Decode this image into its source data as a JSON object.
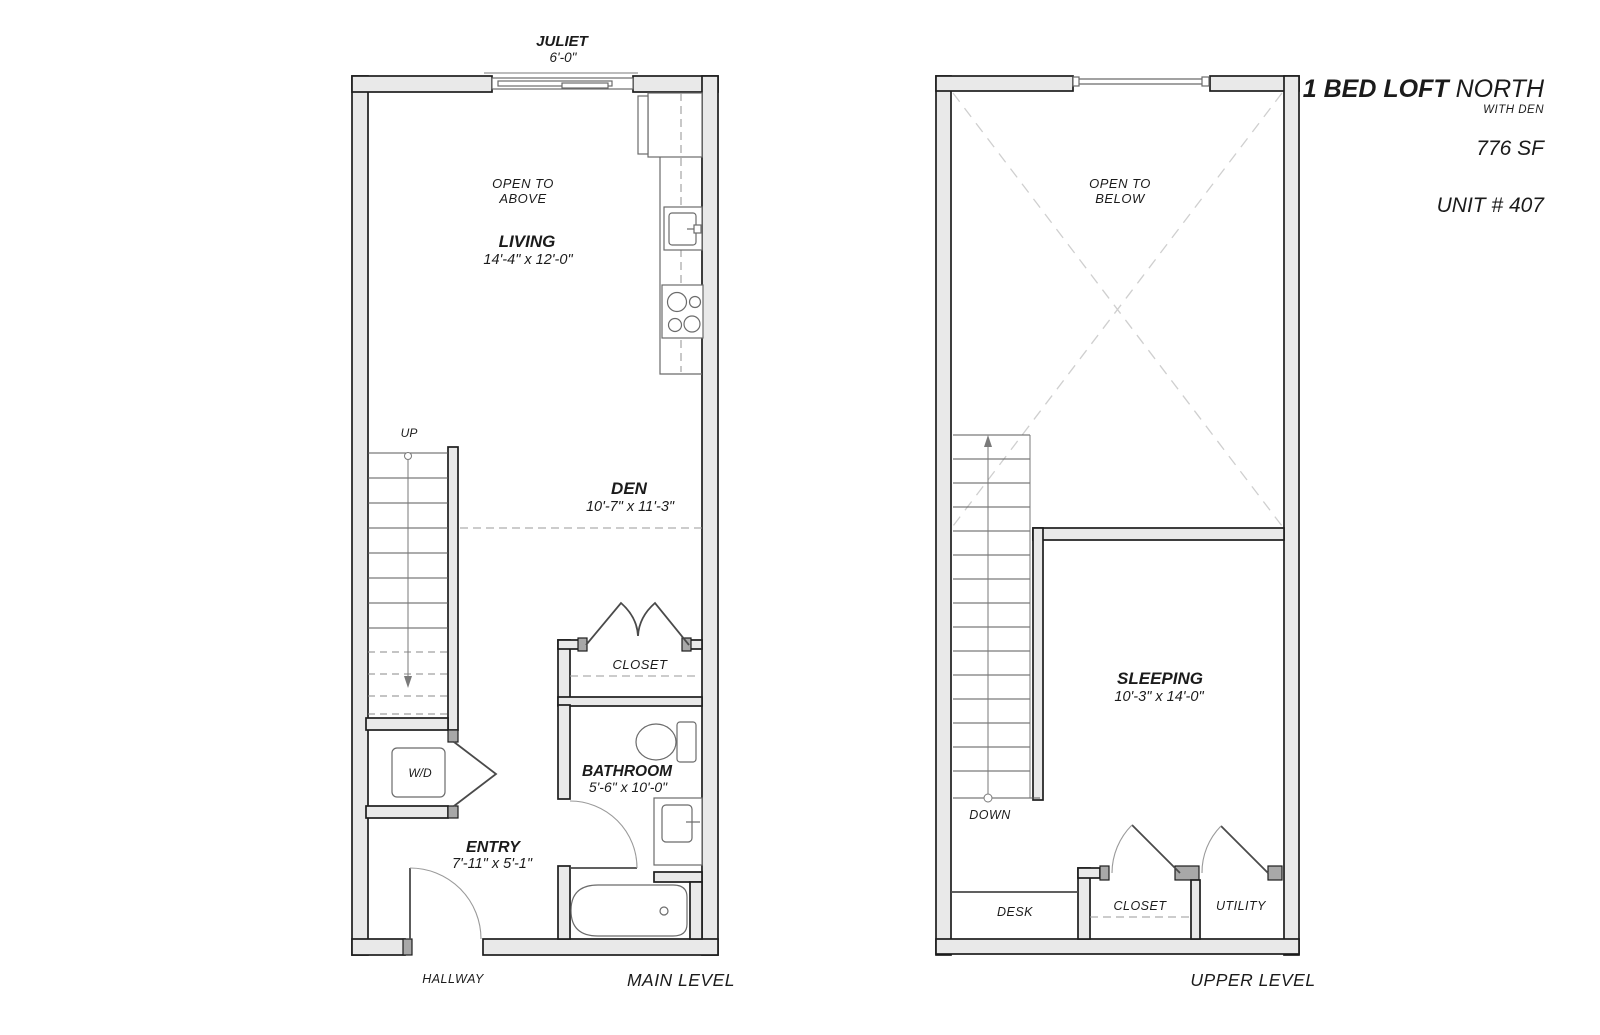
{
  "title_block": {
    "name_bold": "1 BED LOFT",
    "name_regular": " NORTH",
    "subtitle": "WITH DEN",
    "area": "776 SF",
    "unit": "UNIT # 407"
  },
  "main_level": {
    "caption": "MAIN LEVEL",
    "juliet": {
      "label": "JULIET",
      "dim": "6'-0\""
    },
    "open_to_above": {
      "line1": "OPEN TO",
      "line2": "ABOVE"
    },
    "living": {
      "label": "LIVING",
      "dim": "14'-4\" x 12'-0\""
    },
    "den": {
      "label": "DEN",
      "dim": "10'-7\" x 11'-3\""
    },
    "stairs_label": "UP",
    "closet_label": "CLOSET",
    "washer_dryer_label": "W/D",
    "bathroom": {
      "label": "BATHROOM",
      "dim": "5'-6\" x 10'-0\""
    },
    "entry": {
      "label": "ENTRY",
      "dim": "7'-11\" x 5'-1\""
    },
    "hallway_label": "HALLWAY"
  },
  "upper_level": {
    "caption": "UPPER LEVEL",
    "open_to_below": {
      "line1": "OPEN TO",
      "line2": "BELOW"
    },
    "sleeping": {
      "label": "SLEEPING",
      "dim": "10'-3\" x 14'-0\""
    },
    "stairs_label": "DOWN",
    "desk_label": "DESK",
    "closet_label": "CLOSET",
    "utility_label": "UTILITY"
  },
  "colors": {
    "background": "#ffffff",
    "wall_fill": "#e9e9e9",
    "wall_stroke": "#1d1d1d",
    "fixture_stroke": "#6b6b6b",
    "dashed_line": "#9a9a9a",
    "x_brace": "#cfcfcf",
    "text": "#1b1b1b"
  }
}
